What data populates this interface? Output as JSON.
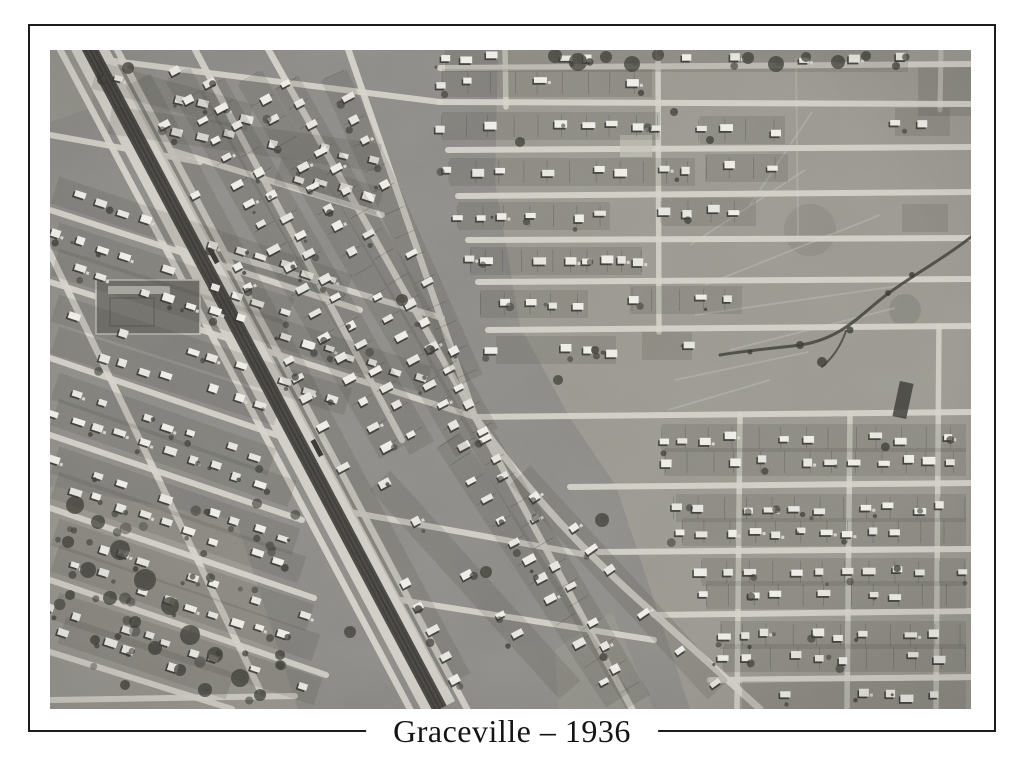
{
  "print": {
    "caption": "Graceville – 1936",
    "kind": "framed black-and-white aerial photograph",
    "description": "Vertical aerial photograph of the Brisbane suburb of Graceville taken in 1936. A railway corridor with flanking service roads cuts diagonally from the upper left to the lower centre. Tilted residential street grids of small timber houses on deep lots fill the left and centre, a rectangular street grid fills the right, and open paddocks crossed by walking tracks and a meandering creek occupy the upper right. A fenced sports ground sits at the middle left and scattered dark tree cover spreads over the lower left paddocks."
  },
  "photo": {
    "features": [
      "railway-line",
      "station-platforms",
      "service-roads",
      "tilted-street-grid",
      "rectangular-street-grid",
      "houses",
      "house-lots",
      "sports-ground",
      "creek",
      "open-paddocks",
      "walking-tracks",
      "tree-cover"
    ],
    "palette": {
      "paper": "#ffffff",
      "frame_line": "#1c1c1c",
      "caption_ink": "#141414",
      "ground": "#8a8884",
      "field": "#99978e",
      "street": "#d8d6cd",
      "rail_corridor": "#d3d1c9",
      "rail_dark": "#454440",
      "rail_track": "#383732",
      "house": "#eae9e3",
      "house_bright": "#f2f1eb",
      "house_shadow": "#2e2d29",
      "vegetation": "#35342e",
      "creek": "#3c3b36"
    }
  }
}
